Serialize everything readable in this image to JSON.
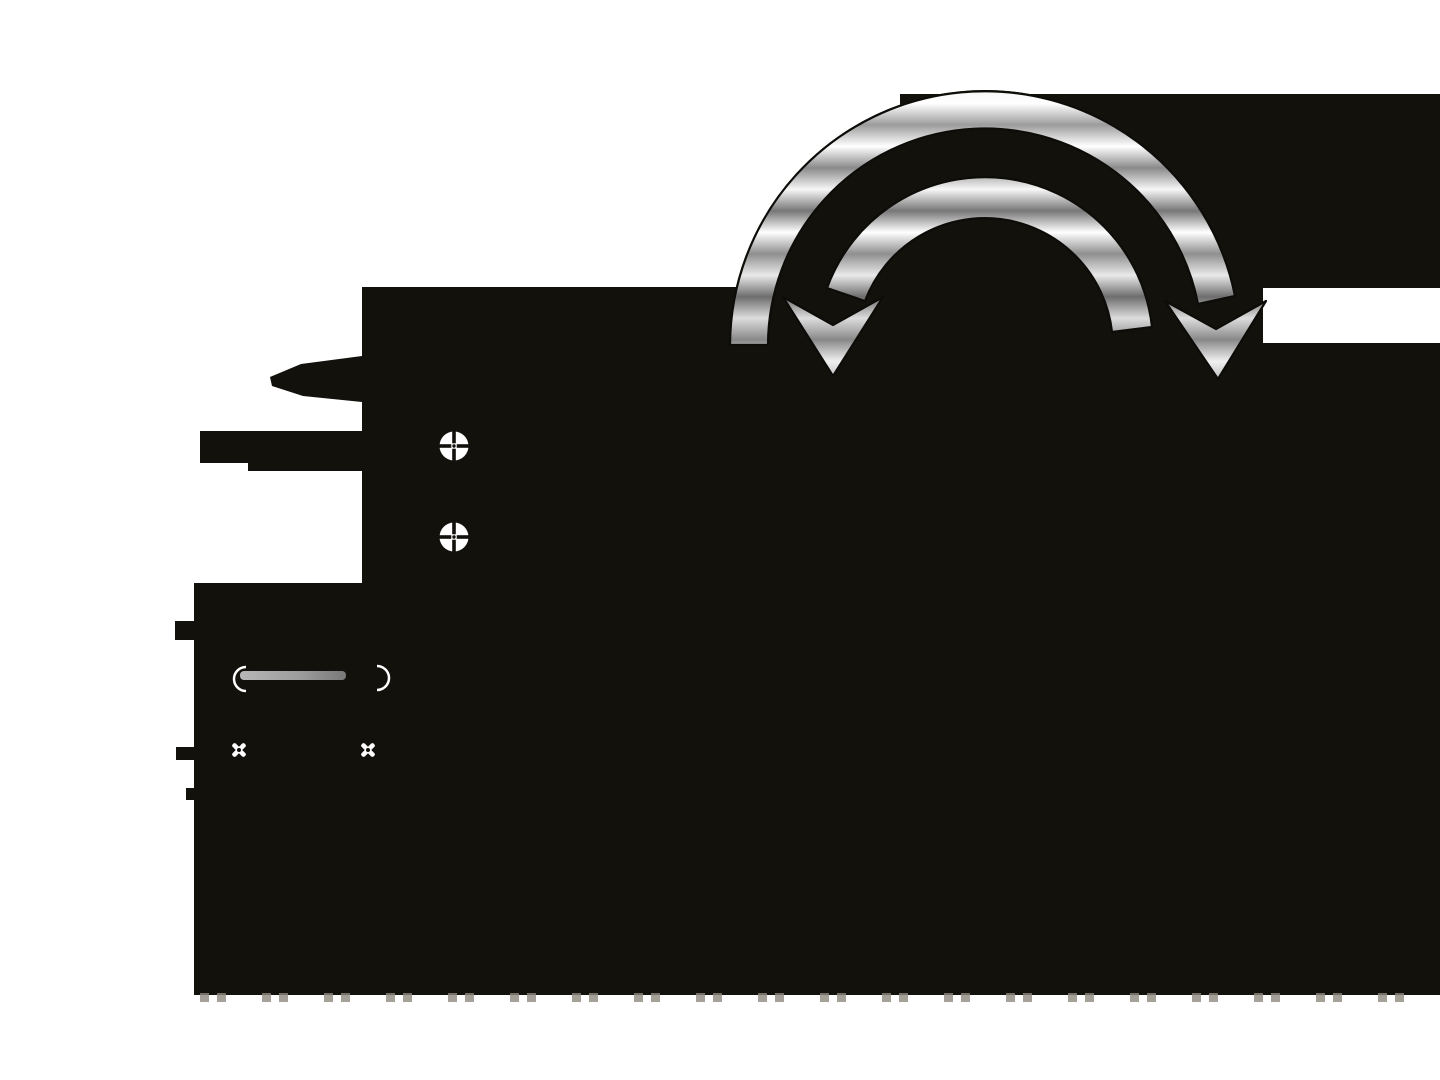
{
  "meta": {
    "kind": "appliance-manual-illustration",
    "description": "Black appliance silhouette with two chrome curved rotate arrows pointing down, crosshair screw markers, metal rod and fastener crosses"
  },
  "canvas": {
    "width": 1440,
    "height": 1080
  },
  "colors": {
    "bg": "#ffffff",
    "body": "#13110c",
    "outline": "#0d0c08",
    "white": "#ffffff",
    "rodLight": "#b7b7b7",
    "rodDark": "#787878",
    "tick": "#8f8a80"
  },
  "arrows": {
    "outer": {
      "name": "rotate-arrow-outer",
      "direction": "down-right",
      "finish": "chrome"
    },
    "inner": {
      "name": "rotate-arrow-inner",
      "direction": "down-left",
      "finish": "chrome"
    }
  },
  "positions": {
    "crosshair_screw_1": "translate(454 446)",
    "crosshair_screw_2": "translate(454 537)",
    "cross_screw_1": "translate(239 750)",
    "cross_screw_2": "translate(368 750)"
  },
  "ticks": {
    "start_x": 200,
    "count": 20,
    "step": 62,
    "pair_offset": 17,
    "width": 9,
    "height": 9,
    "y": 993
  }
}
